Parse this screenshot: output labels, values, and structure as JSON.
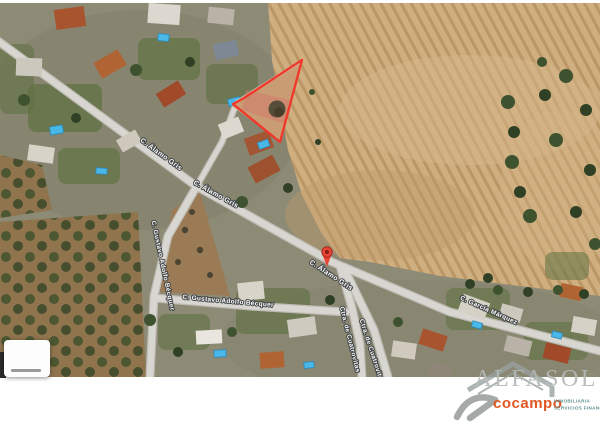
{
  "map": {
    "type": "satellite-aerial-view",
    "street_labels": [
      {
        "text": "C. Álamo Gris"
      },
      {
        "text": "C. Álamo Gris"
      },
      {
        "text": "C. Álamo Gris"
      },
      {
        "text": "C. Gustavo Adolfo Bécquer"
      },
      {
        "text": "C. Gustavo Adolfo Bécquer"
      },
      {
        "text": "Ctra. de Cuatrovitas"
      },
      {
        "text": "Ctra. de Cuatrovitas"
      },
      {
        "text": "C. García Márquez"
      }
    ],
    "colors": {
      "field": "#cfae80",
      "furrow": "#bb9766",
      "road": "#d8d6d0",
      "road_edge": "#bdbab2",
      "residential_ground": "#8d8a76",
      "lawn": "#5f7243",
      "grove_soil": "#8f744e",
      "olive_tree": "#46542f",
      "parcel_outline": "#f1392b",
      "parcel_fill": "rgba(241,57,43,0.10)",
      "pin": "#e94335",
      "pool": "#49b8e8"
    }
  },
  "logo": {
    "brand": "ALFASOL",
    "sub_brand": "cocampo",
    "tagline_line1": "INMOBILIARIA",
    "tagline_line2": "SERVICIOS FINANCIEROS",
    "colors": {
      "brand": "#b4b9b7",
      "sub_brand": "#e04a12",
      "tagline": "#4f8584",
      "house_outline": "#98a19e"
    }
  }
}
